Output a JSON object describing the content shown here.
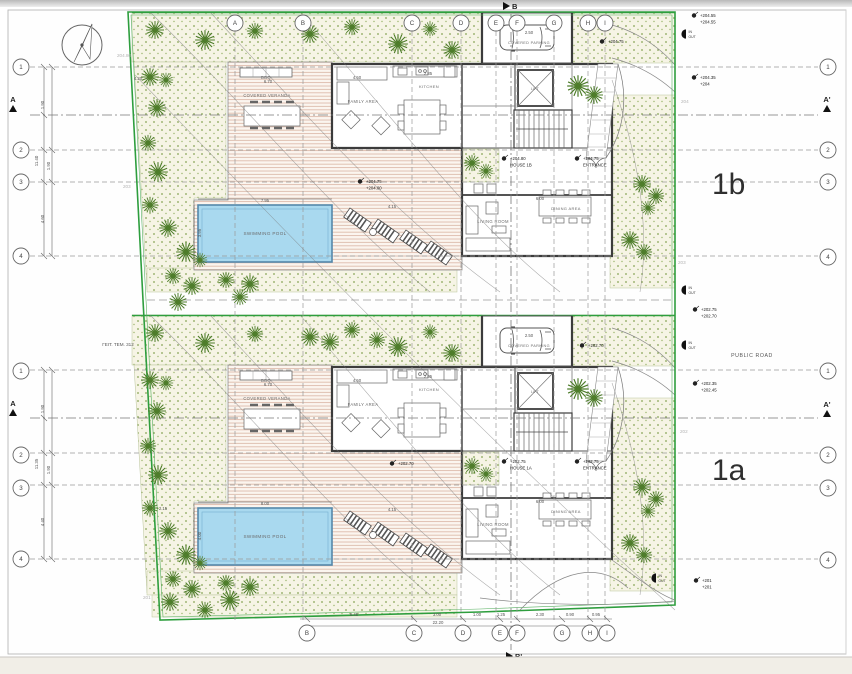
{
  "site": {
    "neighbor_plot_label": "ΓΕΙΤ. ΤΕΜ. 312",
    "public_road_label": "PUBLIC ROAD"
  },
  "units": {
    "b": {
      "label": "1b"
    },
    "a": {
      "label": "1a"
    }
  },
  "sections": {
    "a": "A",
    "a_prime": "A'",
    "b": "B",
    "b_prime": "B'"
  },
  "rooms": {
    "bbq": "BBQ",
    "covered_veranda": "COVERED VERANDA",
    "family_area": "FAMILY AREA",
    "kitchen": "KITCHEN",
    "lift": "LIFT",
    "covered_parking": "COVERED PARKING",
    "living_room": "LIVING ROOM",
    "dining_area": "DINING AREA",
    "swimming_pool": "SWIMMING POOL"
  },
  "io": {
    "in_label": "IN",
    "out_label": "OUT"
  },
  "grid_bubbles": [
    {
      "t": "A",
      "x": 235,
      "y": 23
    },
    {
      "t": "B",
      "x": 303,
      "y": 23
    },
    {
      "t": "C",
      "x": 412,
      "y": 23
    },
    {
      "t": "D",
      "x": 461,
      "y": 23
    },
    {
      "t": "E",
      "x": 496,
      "y": 23
    },
    {
      "t": "F",
      "x": 517,
      "y": 23
    },
    {
      "t": "G",
      "x": 554,
      "y": 23
    },
    {
      "t": "H",
      "x": 588,
      "y": 23
    },
    {
      "t": "I",
      "x": 605,
      "y": 23
    },
    {
      "t": "B",
      "x": 307,
      "y": 633
    },
    {
      "t": "C",
      "x": 414,
      "y": 633
    },
    {
      "t": "D",
      "x": 463,
      "y": 633
    },
    {
      "t": "E",
      "x": 500,
      "y": 633
    },
    {
      "t": "F",
      "x": 517,
      "y": 633
    },
    {
      "t": "G",
      "x": 562,
      "y": 633
    },
    {
      "t": "H",
      "x": 590,
      "y": 633
    },
    {
      "t": "I",
      "x": 607,
      "y": 633
    },
    {
      "t": "1",
      "x": 21,
      "y": 67
    },
    {
      "t": "2",
      "x": 21,
      "y": 150
    },
    {
      "t": "3",
      "x": 21,
      "y": 182
    },
    {
      "t": "4",
      "x": 21,
      "y": 256
    },
    {
      "t": "1",
      "x": 828,
      "y": 67
    },
    {
      "t": "2",
      "x": 828,
      "y": 150
    },
    {
      "t": "3",
      "x": 828,
      "y": 182
    },
    {
      "t": "4",
      "x": 828,
      "y": 257
    },
    {
      "t": "1",
      "x": 21,
      "y": 371
    },
    {
      "t": "2",
      "x": 21,
      "y": 455
    },
    {
      "t": "3",
      "x": 21,
      "y": 488
    },
    {
      "t": "4",
      "x": 21,
      "y": 559
    },
    {
      "t": "1",
      "x": 828,
      "y": 371
    },
    {
      "t": "2",
      "x": 828,
      "y": 455
    },
    {
      "t": "3",
      "x": 828,
      "y": 488
    },
    {
      "t": "4",
      "x": 828,
      "y": 560
    }
  ],
  "level_markers": [
    {
      "lines": [
        "+204.55",
        "+204.55"
      ],
      "x": 700,
      "y": 14
    },
    {
      "lines": [
        "+204.35",
        "+204"
      ],
      "x": 700,
      "y": 76
    },
    {
      "lines": [
        "+204.75"
      ],
      "x": 608,
      "y": 40
    },
    {
      "lines": [
        "+204.80",
        "HOUSE 1B"
      ],
      "x": 510,
      "y": 157
    },
    {
      "lines": [
        "+204.75",
        "ENTRANCE"
      ],
      "x": 583,
      "y": 157
    },
    {
      "lines": [
        "+204.75",
        "+204.00"
      ],
      "x": 366,
      "y": 180
    },
    {
      "lines": [
        "+202.75",
        "+202.70"
      ],
      "x": 701,
      "y": 308
    },
    {
      "lines": [
        "+202.70"
      ],
      "x": 588,
      "y": 344
    },
    {
      "lines": [
        "+202.35",
        "+202.45"
      ],
      "x": 701,
      "y": 382
    },
    {
      "lines": [
        "+202.75",
        "HOUSE 1A"
      ],
      "x": 510,
      "y": 460
    },
    {
      "lines": [
        "+202.75",
        "ENTRANCE"
      ],
      "x": 583,
      "y": 460
    },
    {
      "lines": [
        "+202.70"
      ],
      "x": 398,
      "y": 462
    },
    {
      "lines": [
        "+201",
        "+201"
      ],
      "x": 702,
      "y": 579
    }
  ],
  "dim_texts": [
    {
      "t": "1.90",
      "x": 44,
      "y": 105,
      "rot": true
    },
    {
      "t": "11.40",
      "x": 38,
      "y": 161,
      "rot": true
    },
    {
      "t": "1.90",
      "x": 50,
      "y": 166,
      "rot": true
    },
    {
      "t": "4.60",
      "x": 44,
      "y": 219,
      "rot": true
    },
    {
      "t": "1.90",
      "x": 44,
      "y": 409,
      "rot": true
    },
    {
      "t": "11.35",
      "x": 38,
      "y": 464,
      "rot": true
    },
    {
      "t": "1.90",
      "x": 50,
      "y": 470,
      "rot": true
    },
    {
      "t": "4.40",
      "x": 44,
      "y": 522,
      "rot": true
    },
    {
      "t": "7.95",
      "x": 265,
      "y": 202
    },
    {
      "t": "3.95",
      "x": 201,
      "y": 233,
      "rot": true
    },
    {
      "t": "8.00",
      "x": 265,
      "y": 505
    },
    {
      "t": "4.00",
      "x": 201,
      "y": 536,
      "rot": true
    },
    {
      "t": "6.70",
      "x": 268,
      "y": 83
    },
    {
      "t": "4.50",
      "x": 357,
      "y": 79
    },
    {
      "t": "2.85",
      "x": 428,
      "y": 75
    },
    {
      "t": "6.00",
      "x": 540,
      "y": 200
    },
    {
      "t": "2.50",
      "x": 529,
      "y": 34
    },
    {
      "t": "4.15",
      "x": 392,
      "y": 208
    },
    {
      "t": "6.70",
      "x": 268,
      "y": 386
    },
    {
      "t": "4.50",
      "x": 357,
      "y": 382
    },
    {
      "t": "2.85",
      "x": 428,
      "y": 378
    },
    {
      "t": "6.00",
      "x": 540,
      "y": 503
    },
    {
      "t": "2.50",
      "x": 529,
      "y": 337
    },
    {
      "t": "4.15",
      "x": 392,
      "y": 511
    },
    {
      "t": "4.20",
      "x": 138,
      "y": 80
    },
    {
      "t": "2.15",
      "x": 163,
      "y": 510
    },
    {
      "t": "6.45",
      "x": 354,
      "y": 616
    },
    {
      "t": "3.00",
      "x": 437,
      "y": 616
    },
    {
      "t": "1.00",
      "x": 477,
      "y": 616
    },
    {
      "t": "1.25",
      "x": 501,
      "y": 616
    },
    {
      "t": "2.30",
      "x": 540,
      "y": 616
    },
    {
      "t": "0.90",
      "x": 570,
      "y": 616
    },
    {
      "t": "0.95",
      "x": 596,
      "y": 616
    },
    {
      "t": "22.20",
      "x": 438,
      "y": 624
    }
  ],
  "io_markers": [
    {
      "x": 686,
      "y": 34
    },
    {
      "x": 686,
      "y": 290
    },
    {
      "x": 686,
      "y": 345
    },
    {
      "x": 656,
      "y": 578
    }
  ],
  "contour_labels": [
    {
      "t": "203",
      "x": 123,
      "y": 188
    },
    {
      "t": "204",
      "x": 681,
      "y": 103
    },
    {
      "t": "203",
      "x": 678,
      "y": 264
    },
    {
      "t": "202",
      "x": 680,
      "y": 433
    },
    {
      "t": "201",
      "x": 143,
      "y": 599
    },
    {
      "t": "204.80",
      "x": 117,
      "y": 57
    }
  ]
}
